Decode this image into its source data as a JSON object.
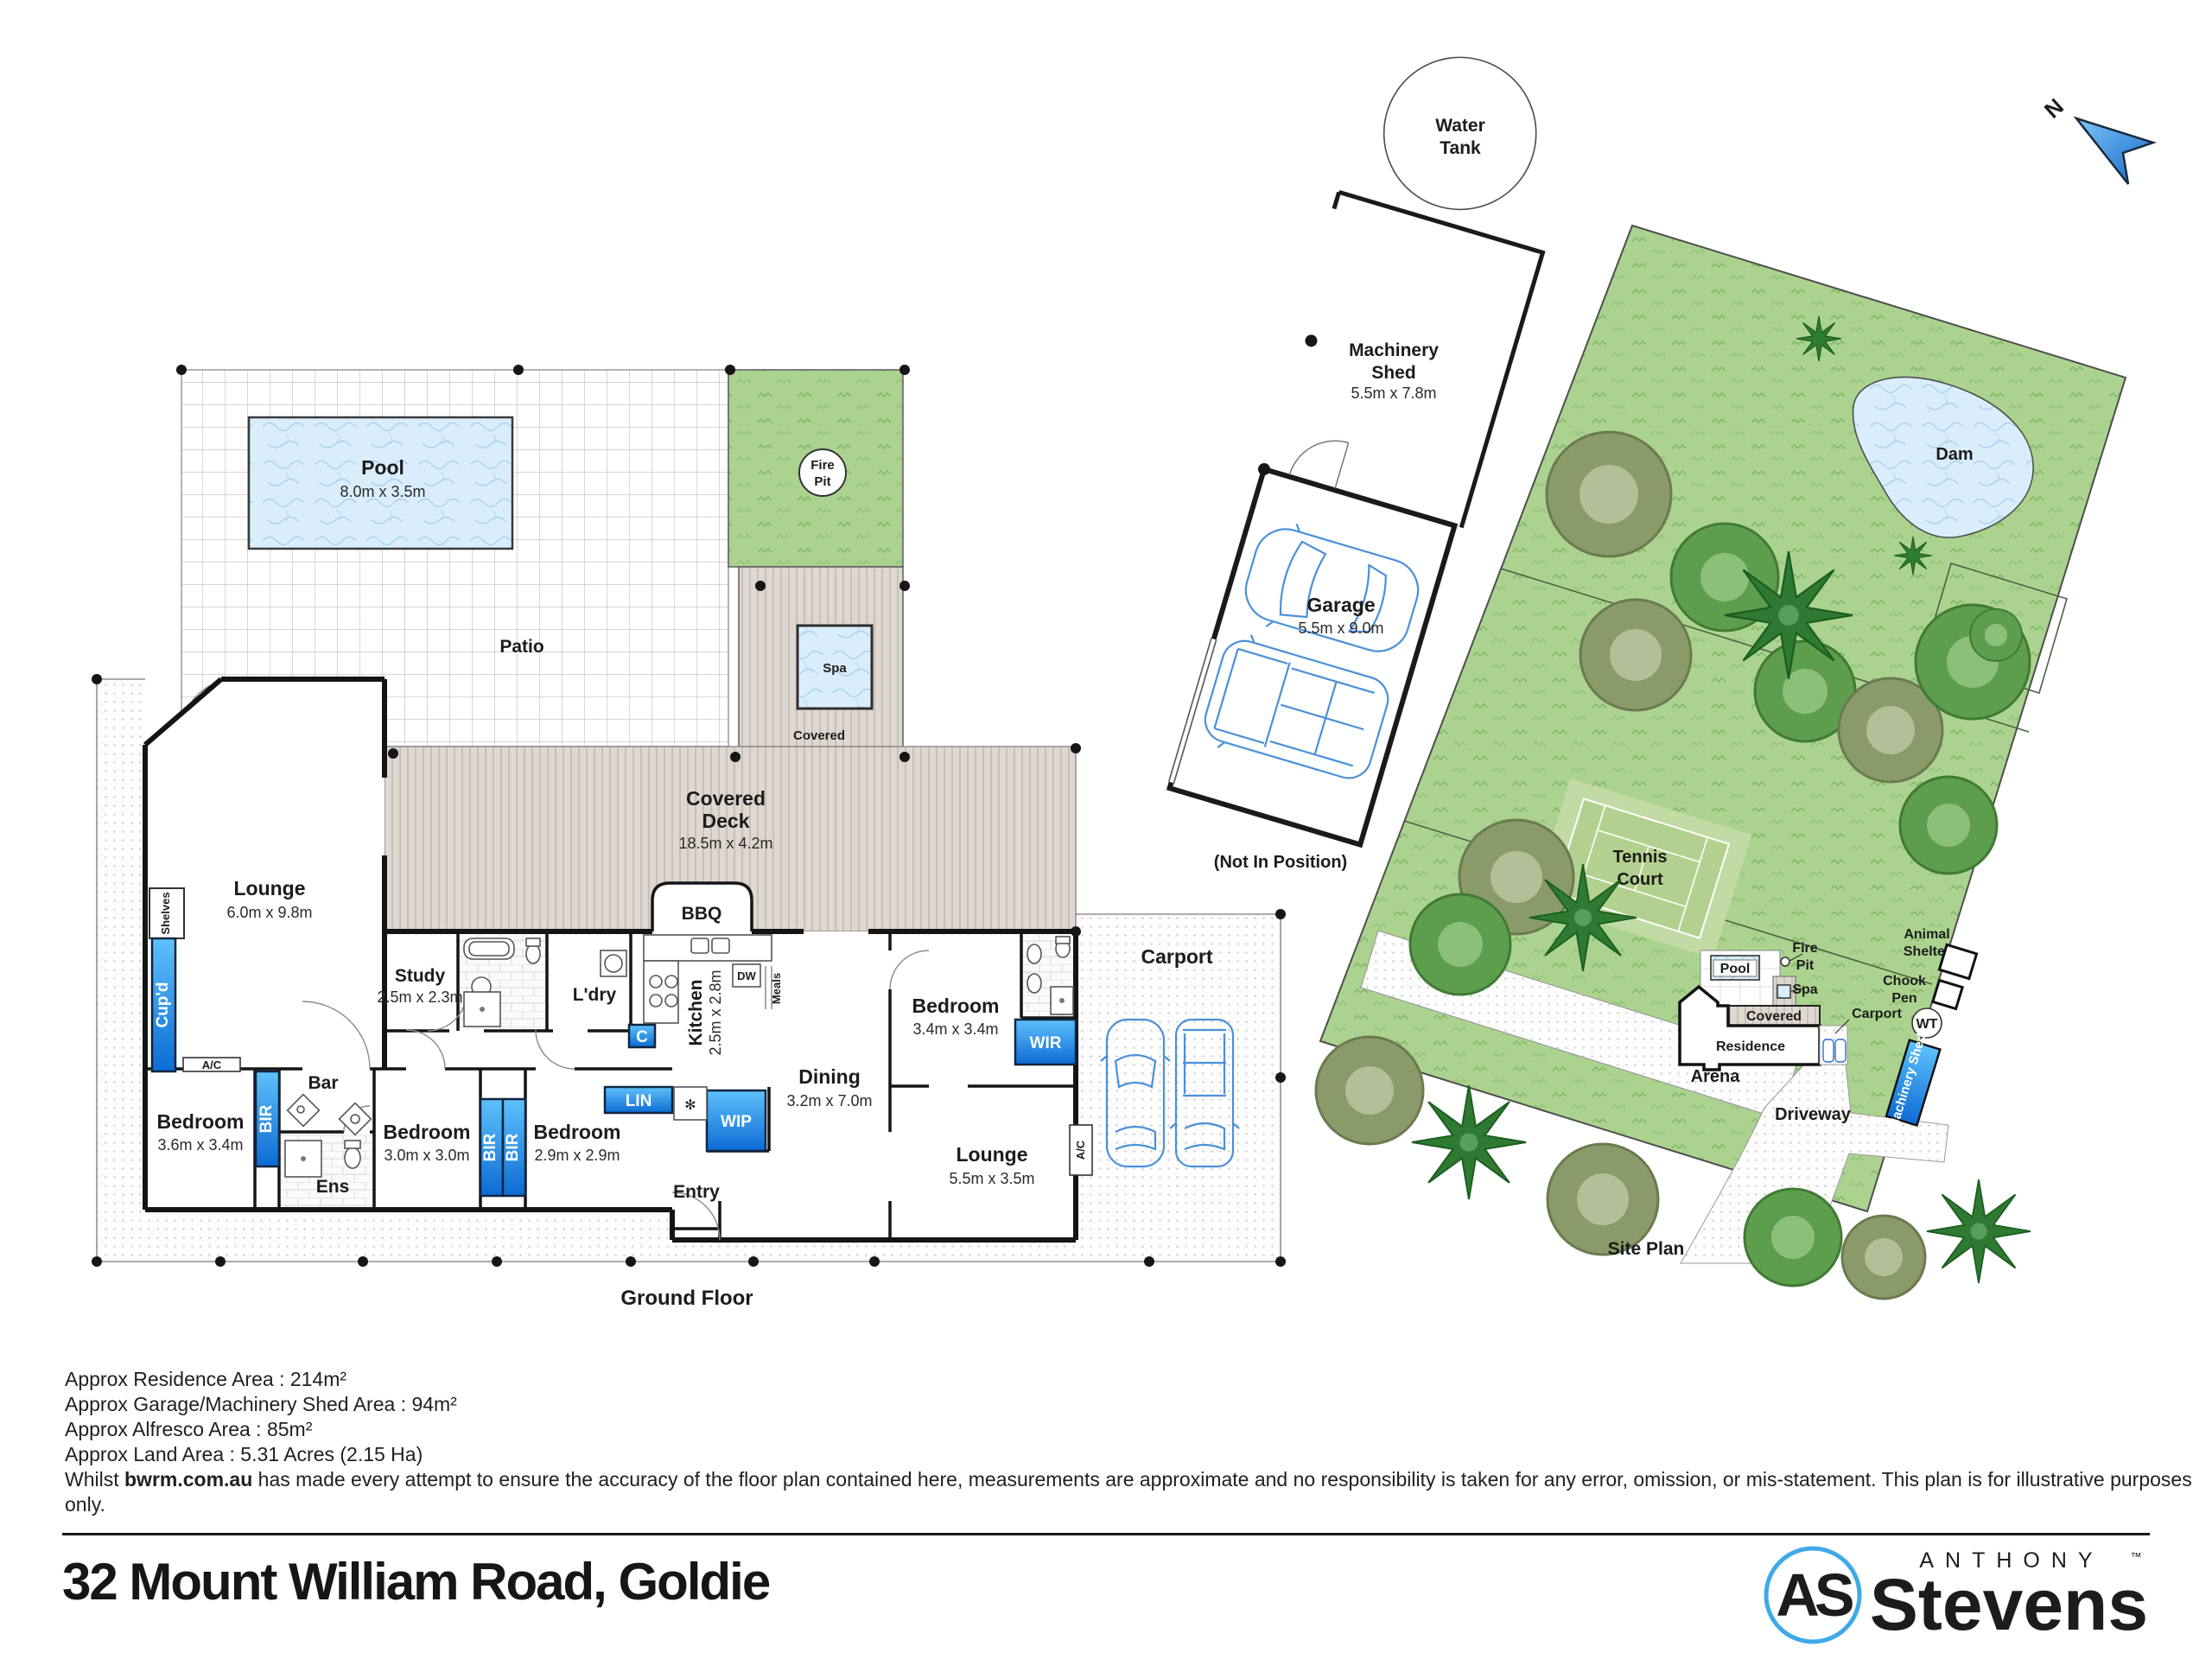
{
  "title": "32 Mount William Road, Goldie",
  "compass": {
    "n": "N"
  },
  "floor_plan": {
    "ground_floor": "Ground Floor",
    "patio": "Patio",
    "pool": {
      "name": "Pool",
      "dim": "8.0m x 3.5m"
    },
    "fire_pit": [
      "Fire",
      "Pit"
    ],
    "spa": "Spa",
    "spa_covered": "Covered",
    "deck": [
      "Covered",
      "Deck",
      "18.5m x 4.2m"
    ],
    "bbq": "BBQ",
    "lounge": {
      "name": "Lounge",
      "dim": "6.0m x 9.8m"
    },
    "shelves": "Shelves",
    "cupd": "Cup'd",
    "ac": "A/C",
    "study": {
      "name": "Study",
      "dim": "2.5m x 2.3m"
    },
    "ldry": "L'dry",
    "kitchen": {
      "name": "Kitchen",
      "dim": "2.5m x 2.8m"
    },
    "dw": "DW",
    "meals": "Meals",
    "c": "C",
    "dining": {
      "name": "Dining",
      "dim": "3.2m x 7.0m"
    },
    "bed_master": {
      "name": "Bedroom",
      "dim": "3.4m x 3.4m"
    },
    "wir": "WIR",
    "carport": "Carport",
    "bed1": {
      "name": "Bedroom",
      "dim": "3.6m x 3.4m"
    },
    "bir": "BIR",
    "bar": "Bar",
    "ens": "Ens",
    "bed2": {
      "name": "Bedroom",
      "dim": "3.0m x 3.0m"
    },
    "bed3": {
      "name": "Bedroom",
      "dim": "2.9m x 2.9m"
    },
    "lin": "LIN",
    "wip": "WIP",
    "entry": "Entry",
    "lounge2": {
      "name": "Lounge",
      "dim": "5.5m x 3.5m"
    }
  },
  "garage_plan": {
    "water_tank": [
      "Water",
      "Tank"
    ],
    "machinery_shed": [
      "Machinery",
      "Shed",
      "5.5m x 7.8m"
    ],
    "garage": {
      "name": "Garage",
      "dim": "5.5m x 9.0m"
    },
    "note": "(Not In Position)"
  },
  "site_plan": {
    "title": "Site Plan",
    "dam": "Dam",
    "tennis": [
      "Tennis",
      "Court"
    ],
    "arena": "Arena",
    "pool": "Pool",
    "fire_pit": [
      "Fire",
      "Pit"
    ],
    "spa": "Spa",
    "covered": "Covered",
    "residence": "Residence",
    "carport": "Carport",
    "animal_shelter": [
      "Animal",
      "Shelter"
    ],
    "chook_pen": [
      "Chook",
      "Pen"
    ],
    "wt": "WT",
    "machinery_shed": "Machinery Shed",
    "driveway": "Driveway"
  },
  "footer": {
    "areas": [
      "Approx Residence Area : 214m²",
      "Approx Garage/Machinery Shed Area : 94m²",
      "Approx Alfresco Area : 85m²",
      "Approx Land Area : 5.31 Acres (2.15 Ha)"
    ],
    "disclaimer_prefix": "Whilst ",
    "disclaimer_site": "bwrm.com.au",
    "disclaimer_rest": " has made every attempt to ensure the accuracy of the floor plan contained here, measurements are approximate and no responsibility is taken for any error, omission, or mis-statement. This plan is for illustrative purposes only."
  },
  "brand": {
    "initials": "AS",
    "top": "ANTHONY",
    "tm": "™",
    "name": "Stevens"
  },
  "colors": {
    "cabinet_blue": "#1e90e8",
    "grass": "#abd38f",
    "water": "#d9edfb",
    "deck": "#ded8d0",
    "logo_blue": "#2a6fb8"
  }
}
